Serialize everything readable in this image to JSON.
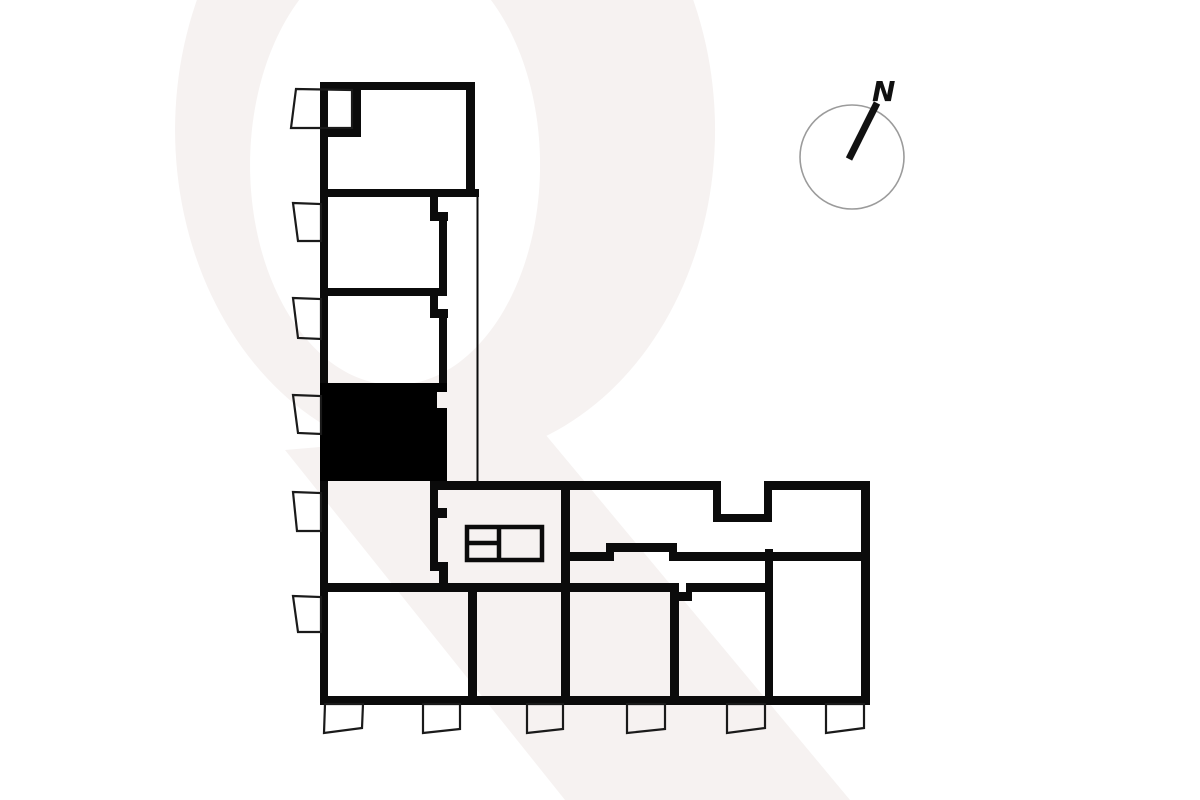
{
  "page": {
    "kind": "residential floor plan, L-shaped building, one unit highlighted"
  },
  "colors": {
    "bg": "#ffffff",
    "wall": "#0b0b0b",
    "highlight": "#000000",
    "wm": "#f6f2f1",
    "ring": "#9b9b9b",
    "needle": "#111111",
    "label": "#111111",
    "balcony": "#1a1a1a"
  },
  "compass": {
    "label": "N"
  },
  "plan": {
    "highlighted_unit": "4th unit of left (vertical) wing, filled solid black",
    "vertical_wing_units": 5,
    "bottom_row_units": 5,
    "left_balconies": 6,
    "bottom_balconies": 6,
    "has_stair_core_symbol": true,
    "has_inset_balcony_notch_top_right": true
  }
}
